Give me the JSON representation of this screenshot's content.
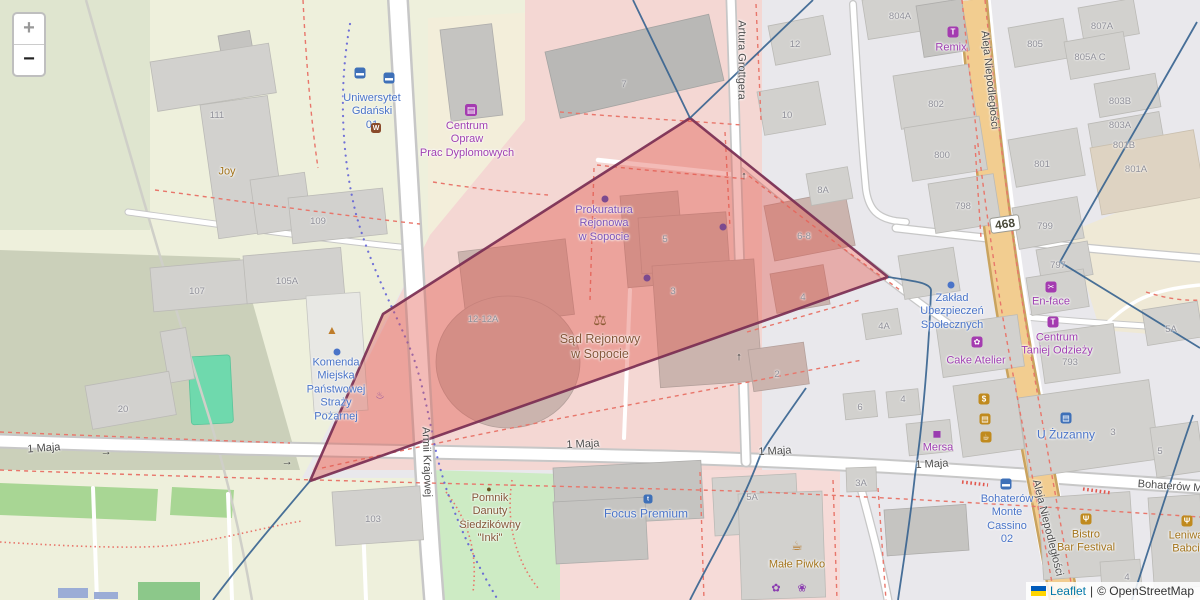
{
  "zoom_control": {
    "zoom_in": "+",
    "zoom_out": "−"
  },
  "attribution": {
    "leaflet_label": "Leaflet",
    "separator": "|",
    "osm_label": "© OpenStreetMap"
  },
  "colors": {
    "base": "#e9e8ec",
    "campus": "#eef0dc",
    "campus_dark": "#cbd0ba",
    "campus_shade": "#dfe5cf",
    "park": "#cdebc4",
    "pitch": "#6fd9ad",
    "strip_green": "#a8d694",
    "retail_pink": "#f4d7d3",
    "retail_pink2": "#f6dbd8",
    "cream": "#f3eeda",
    "beige_area": "#efe9d6",
    "road_fill": "#ffffff",
    "road_casing": "#c7c7c7",
    "primary_fill": "#f2cd90",
    "primary_casing": "#c9a35f",
    "building": "#d2d1ce",
    "building_stroke": "#bbbab6",
    "building_dark": "#c5c4c1",
    "building_darker": "#b9b8b6",
    "building_warm": "#cbb4ae",
    "building_inst": "#e8e8e4",
    "building_beige": "#ded3c2",
    "dash_red": "#e8766b",
    "cross_red": "#e2574d",
    "path_blue": "#5b5bd6",
    "boundary": "#35628f",
    "polygon_fill": "#e0564c",
    "polygon_stroke": "#7a2e52",
    "label_street": "#4d4d4d",
    "label_house": "#8f8f98",
    "poi_blue": "#4a74c8",
    "poi_purple": "#a041b2",
    "poi_violet": "#7d54b8",
    "poi_amber": "#a3741c",
    "poi_brown": "#85573a",
    "badge_blue": "#3e70b8",
    "badge_purple": "#a43bb0",
    "badge_gold": "#c08a1e",
    "badge_brown": "#8a4a2a",
    "link": "#0078A8",
    "flag_blue": "#005BBB",
    "flag_yellow": "#FFD500"
  },
  "map": {
    "route_shield": {
      "text": "468"
    },
    "street_labels": [
      {
        "name": "street-1-maja-west",
        "text": "1 Maja",
        "x": 44,
        "y": 449,
        "rot": -4
      },
      {
        "name": "street-1-maja-center",
        "text": "1 Maja",
        "x": 583,
        "y": 445,
        "rot": -3
      },
      {
        "name": "street-1-maja-center2",
        "text": "1 Maja",
        "x": 775,
        "y": 452,
        "rot": -3
      },
      {
        "name": "street-1-maja-east",
        "text": "1 Maja",
        "x": 932,
        "y": 465,
        "rot": -3
      },
      {
        "name": "street-bohaterow-monte-cassino",
        "text": "Bohaterów M",
        "x": 1170,
        "y": 487,
        "rot": 4
      },
      {
        "name": "street-armii-krajowej",
        "text": "Armii Krajowej",
        "x": 426,
        "y": 462,
        "rot": 88
      },
      {
        "name": "street-artura-grottgera",
        "text": "Artura Grottgera",
        "x": 741,
        "y": 60,
        "rot": 90
      },
      {
        "name": "street-aleja-niepodleglosci-north",
        "text": "Aleja Niepodległości",
        "x": 989,
        "y": 80,
        "rot": 84
      },
      {
        "name": "street-aleja-niepodleglosci-south",
        "text": "Aleja Niepodległości",
        "x": 1047,
        "y": 528,
        "rot": 76
      }
    ],
    "house_numbers": [
      {
        "text": "111",
        "x": 217,
        "y": 116
      },
      {
        "text": "109",
        "x": 318,
        "y": 222
      },
      {
        "text": "107",
        "x": 197,
        "y": 292
      },
      {
        "text": "105A",
        "x": 287,
        "y": 282
      },
      {
        "text": "20",
        "x": 123,
        "y": 410
      },
      {
        "text": "103",
        "x": 373,
        "y": 520
      },
      {
        "text": "12-12A",
        "x": 483,
        "y": 320
      },
      {
        "text": "7",
        "x": 624,
        "y": 85
      },
      {
        "text": "5",
        "x": 665,
        "y": 240
      },
      {
        "text": "3",
        "x": 673,
        "y": 292
      },
      {
        "text": "12",
        "x": 795,
        "y": 45
      },
      {
        "text": "10",
        "x": 787,
        "y": 116
      },
      {
        "text": "8A",
        "x": 823,
        "y": 191
      },
      {
        "text": "6-8",
        "x": 804,
        "y": 237
      },
      {
        "text": "4",
        "x": 803,
        "y": 298
      },
      {
        "text": "2",
        "x": 777,
        "y": 375
      },
      {
        "text": "6",
        "x": 860,
        "y": 408
      },
      {
        "text": "4",
        "x": 903,
        "y": 400
      },
      {
        "text": "4A",
        "x": 884,
        "y": 327
      },
      {
        "text": "804A",
        "x": 900,
        "y": 17
      },
      {
        "text": "802",
        "x": 936,
        "y": 105
      },
      {
        "text": "800",
        "x": 942,
        "y": 156
      },
      {
        "text": "798",
        "x": 963,
        "y": 207
      },
      {
        "text": "801",
        "x": 1042,
        "y": 165
      },
      {
        "text": "799",
        "x": 1045,
        "y": 227
      },
      {
        "text": "797",
        "x": 1058,
        "y": 266
      },
      {
        "text": "793",
        "x": 1070,
        "y": 363
      },
      {
        "text": "807A",
        "x": 1102,
        "y": 27
      },
      {
        "text": "805",
        "x": 1035,
        "y": 45
      },
      {
        "text": "805A C",
        "x": 1090,
        "y": 58
      },
      {
        "text": "803B",
        "x": 1120,
        "y": 102
      },
      {
        "text": "803A",
        "x": 1120,
        "y": 126
      },
      {
        "text": "801B",
        "x": 1124,
        "y": 146
      },
      {
        "text": "801A",
        "x": 1136,
        "y": 170
      },
      {
        "text": "5A",
        "x": 1171,
        "y": 330
      },
      {
        "text": "3",
        "x": 1113,
        "y": 433
      },
      {
        "text": "5",
        "x": 1160,
        "y": 452
      },
      {
        "text": "5A",
        "x": 752,
        "y": 498
      },
      {
        "text": "3A",
        "x": 861,
        "y": 484
      },
      {
        "text": "4",
        "x": 1127,
        "y": 578
      }
    ],
    "poi_labels": [
      {
        "name": "poi-uniwersytet-gdanski",
        "text": "Uniwersytet\nGdański\n01",
        "x": 372,
        "y": 112,
        "c": "blue"
      },
      {
        "name": "poi-centrum-opraw",
        "text": "Centrum\nOpraw\nPrac Dyplomowych",
        "x": 467,
        "y": 140,
        "c": "purple"
      },
      {
        "name": "poi-prokuratura",
        "text": "Prokuratura\nRejonowa\nw Sopocie",
        "x": 604,
        "y": 224,
        "c": "violet"
      },
      {
        "name": "poi-sad-rejonowy",
        "text": "Sąd Rejonowy\nw Sopocie",
        "x": 600,
        "y": 347,
        "c": "brown",
        "s": 12.5
      },
      {
        "name": "poi-komenda-strazy",
        "text": "Komenda\nMiejska\nPaństwowej\nStraży\nPożarnej",
        "x": 336,
        "y": 390,
        "c": "blue"
      },
      {
        "name": "poi-pomnik-inki",
        "text": "Pomnik\nDanuty\nSiedzikówny\n\"Inki\"",
        "x": 490,
        "y": 519,
        "c": "brown"
      },
      {
        "name": "poi-focus-premium",
        "text": "Focus Premium",
        "x": 646,
        "y": 514,
        "c": "blue",
        "s": 12
      },
      {
        "name": "poi-remix",
        "text": "Remix",
        "x": 951,
        "y": 48,
        "c": "purple"
      },
      {
        "name": "poi-zaklad-ubezpieczen",
        "text": "Zakład\nUbezpieczeń\nSpołecznych",
        "x": 952,
        "y": 312,
        "c": "blue"
      },
      {
        "name": "poi-cake-atelier",
        "text": "Cake Atelier",
        "x": 976,
        "y": 361,
        "c": "purple"
      },
      {
        "name": "poi-en-face",
        "text": "En-face",
        "x": 1051,
        "y": 302,
        "c": "purple"
      },
      {
        "name": "poi-centrum-taniej-odziezy",
        "text": "Centrum\nTaniej Odzieży",
        "x": 1057,
        "y": 345,
        "c": "purple"
      },
      {
        "name": "poi-u-zuzanny",
        "text": "U Żuzanny",
        "x": 1066,
        "y": 435,
        "c": "blue",
        "s": 12
      },
      {
        "name": "poi-mersa",
        "text": "Mersa",
        "x": 938,
        "y": 448,
        "c": "purple"
      },
      {
        "name": "poi-bohaterow-monte-cassino-02",
        "text": "Bohaterów\nMonte\nCassino\n02",
        "x": 1007,
        "y": 520,
        "c": "blue"
      },
      {
        "name": "poi-male-piwko",
        "text": "Małe Piwko",
        "x": 797,
        "y": 565,
        "c": "amber"
      },
      {
        "name": "poi-bistro-bar-festival",
        "text": "Bistro\nBar Festival",
        "x": 1086,
        "y": 542,
        "c": "amber"
      },
      {
        "name": "poi-leniwa-babcia",
        "text": "Leniwa\nBabci",
        "x": 1186,
        "y": 543,
        "c": "amber"
      },
      {
        "name": "poi-joy",
        "text": "Joy",
        "x": 227,
        "y": 172,
        "c": "amber"
      }
    ],
    "icons": [
      {
        "name": "bus-stop-icon",
        "kind": "badge",
        "glyph": "▬",
        "bg": "badge_blue",
        "x": 360,
        "y": 73
      },
      {
        "name": "bus-stop-icon",
        "kind": "badge",
        "glyph": "▬",
        "bg": "badge_blue",
        "x": 389,
        "y": 78
      },
      {
        "name": "tram-stop-icon",
        "kind": "badge",
        "glyph": "W",
        "bg": "badge_brown",
        "x": 376,
        "y": 128,
        "size": 10
      },
      {
        "name": "fire-station-icon",
        "kind": "glyph",
        "glyph": "▲",
        "color": "#bf7d2a",
        "x": 332,
        "y": 330,
        "size": 12
      },
      {
        "name": "poi-dot-icon",
        "kind": "dot",
        "color": "poi_blue",
        "x": 337,
        "y": 352
      },
      {
        "name": "poi-dot-icon",
        "kind": "dot",
        "color": "#7c4a8f",
        "x": 605,
        "y": 199
      },
      {
        "name": "poi-dot-icon",
        "kind": "dot",
        "color": "#7c4a8f",
        "x": 647,
        "y": 278
      },
      {
        "name": "poi-dot-icon",
        "kind": "dot",
        "color": "#7c4a8f",
        "x": 723,
        "y": 227
      },
      {
        "name": "poi-dot-icon",
        "kind": "dot",
        "color": "poi_blue",
        "x": 951,
        "y": 285
      },
      {
        "name": "scales-of-justice-icon",
        "kind": "glyph",
        "glyph": "⚖",
        "color": "#8a5a33",
        "x": 600,
        "y": 320,
        "size": 15
      },
      {
        "name": "monument-icon",
        "kind": "glyph",
        "glyph": "●",
        "color": "#6b5322",
        "x": 489,
        "y": 489,
        "size": 9
      },
      {
        "name": "fountain-icon",
        "kind": "glyph",
        "glyph": "♨",
        "color": "#8a4a9e",
        "x": 380,
        "y": 396,
        "size": 10
      },
      {
        "name": "tshirt-shop-icon",
        "kind": "badge",
        "glyph": "T",
        "bg": "badge_purple",
        "x": 953,
        "y": 32
      },
      {
        "name": "copy-shop-icon",
        "kind": "badge",
        "glyph": "▤",
        "bg": "badge_purple",
        "x": 471,
        "y": 110,
        "size": 12
      },
      {
        "name": "beauty-salon-icon",
        "kind": "badge",
        "glyph": "✂",
        "bg": "badge_purple",
        "x": 1051,
        "y": 287
      },
      {
        "name": "tshirt-shop-icon",
        "kind": "badge",
        "glyph": "T",
        "bg": "badge_purple",
        "x": 1053,
        "y": 322
      },
      {
        "name": "cupcake-icon",
        "kind": "badge",
        "glyph": "✿",
        "bg": "badge_purple",
        "x": 977,
        "y": 342
      },
      {
        "name": "awning-shop-icon",
        "kind": "glyph",
        "glyph": "▅",
        "color": "#9a3bb0",
        "x": 937,
        "y": 433,
        "size": 9
      },
      {
        "name": "atm-icon",
        "kind": "badge",
        "glyph": "$",
        "bg": "badge_gold",
        "x": 984,
        "y": 399
      },
      {
        "name": "shop-icon",
        "kind": "badge",
        "glyph": "▤",
        "bg": "badge_gold",
        "x": 985,
        "y": 419
      },
      {
        "name": "cafe-icon",
        "kind": "badge",
        "glyph": "☕",
        "bg": "badge_gold",
        "x": 986,
        "y": 437
      },
      {
        "name": "shop-icon",
        "kind": "badge",
        "glyph": "▤",
        "bg": "badge_blue",
        "x": 1066,
        "y": 418
      },
      {
        "name": "optician-icon",
        "kind": "badge",
        "glyph": "t",
        "bg": "badge_blue",
        "x": 648,
        "y": 499,
        "size": 9
      },
      {
        "name": "bus-stop-icon",
        "kind": "badge",
        "glyph": "▬",
        "bg": "badge_blue",
        "x": 1006,
        "y": 484
      },
      {
        "name": "beer-icon",
        "kind": "glyph",
        "glyph": "☕",
        "color": "#b5741f",
        "x": 797,
        "y": 546,
        "size": 13
      },
      {
        "name": "flower-shop-icon",
        "kind": "glyph",
        "glyph": "✿",
        "color": "#8a3bb0",
        "x": 776,
        "y": 588,
        "size": 11
      },
      {
        "name": "cupcake-icon",
        "kind": "glyph",
        "glyph": "❀",
        "color": "#8a3bb0",
        "x": 802,
        "y": 588,
        "size": 11
      },
      {
        "name": "restaurant-icon",
        "kind": "badge",
        "glyph": "Ψ",
        "bg": "badge_gold",
        "x": 1086,
        "y": 519
      },
      {
        "name": "restaurant-icon",
        "kind": "badge",
        "glyph": "Ψ",
        "bg": "badge_gold",
        "x": 1187,
        "y": 521
      }
    ],
    "arrows": [
      {
        "glyph": "→",
        "x": 106,
        "y": 452,
        "rot": -2
      },
      {
        "glyph": "→",
        "x": 287,
        "y": 462,
        "rot": -2
      },
      {
        "glyph": "↑",
        "x": 744,
        "y": 176,
        "rot": 0
      },
      {
        "glyph": "↑",
        "x": 739,
        "y": 357,
        "rot": 0
      }
    ]
  }
}
